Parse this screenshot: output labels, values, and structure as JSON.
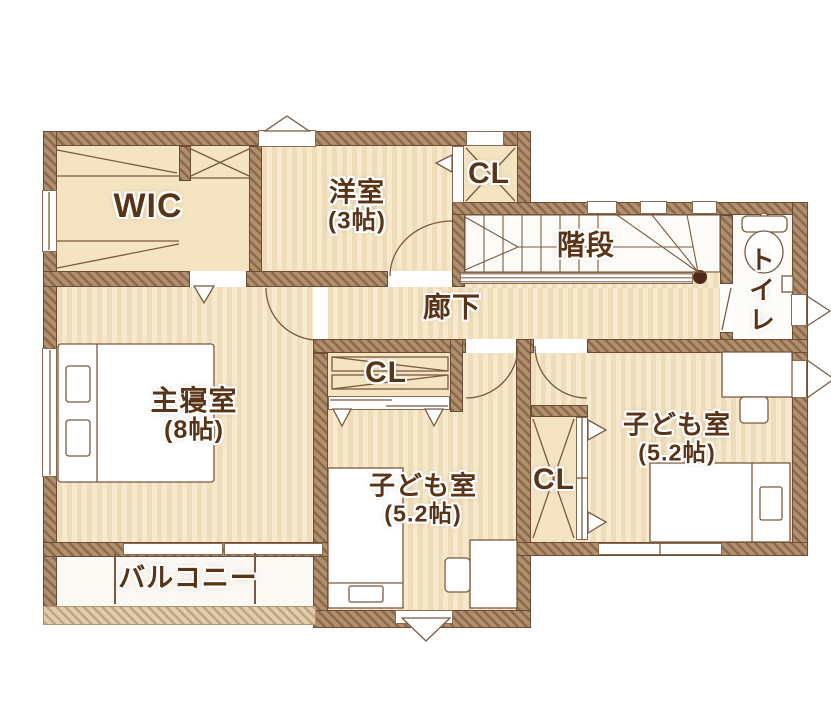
{
  "rooms": {
    "wic": {
      "label": "WIC"
    },
    "western": {
      "label": "洋室",
      "size": "(3帖)"
    },
    "closet_top": {
      "label": "CL"
    },
    "stairs": {
      "label": "階段"
    },
    "hallway": {
      "label": "廊下"
    },
    "toilet": {
      "label": "トイレ"
    },
    "master": {
      "label": "主寝室",
      "size": "(8帖)"
    },
    "closet_mid": {
      "label": "CL"
    },
    "kids_center": {
      "label": "子ども室",
      "size": "(5.2帖)"
    },
    "closet_right": {
      "label": "CL"
    },
    "kids_right": {
      "label": "子ども室",
      "size": "(5.2帖)"
    },
    "balcony": {
      "label": "バルコニー"
    }
  },
  "icons": [
    "bed-icon",
    "pillow-icon",
    "desk-icon",
    "chair-icon",
    "toilet-icon",
    "stairs-treads-icon",
    "hanger-rod-icon",
    "shelf-icon",
    "door-arc-icon",
    "vent-triangle-icon",
    "window-icon",
    "handrail-icon",
    "newel-post-icon",
    "balcony-rail-post-icon"
  ],
  "colors": {
    "wall": "#b08f6e",
    "wall-stroke": "#6d4c35",
    "floor": "#f7e9cd",
    "floor-stripe": "#efddba",
    "floor-plain": "#f4e4c2",
    "rail": "#e1ccab",
    "label": "#5a3417",
    "newel": "#4d2b1b",
    "line": "#7a5a40"
  }
}
